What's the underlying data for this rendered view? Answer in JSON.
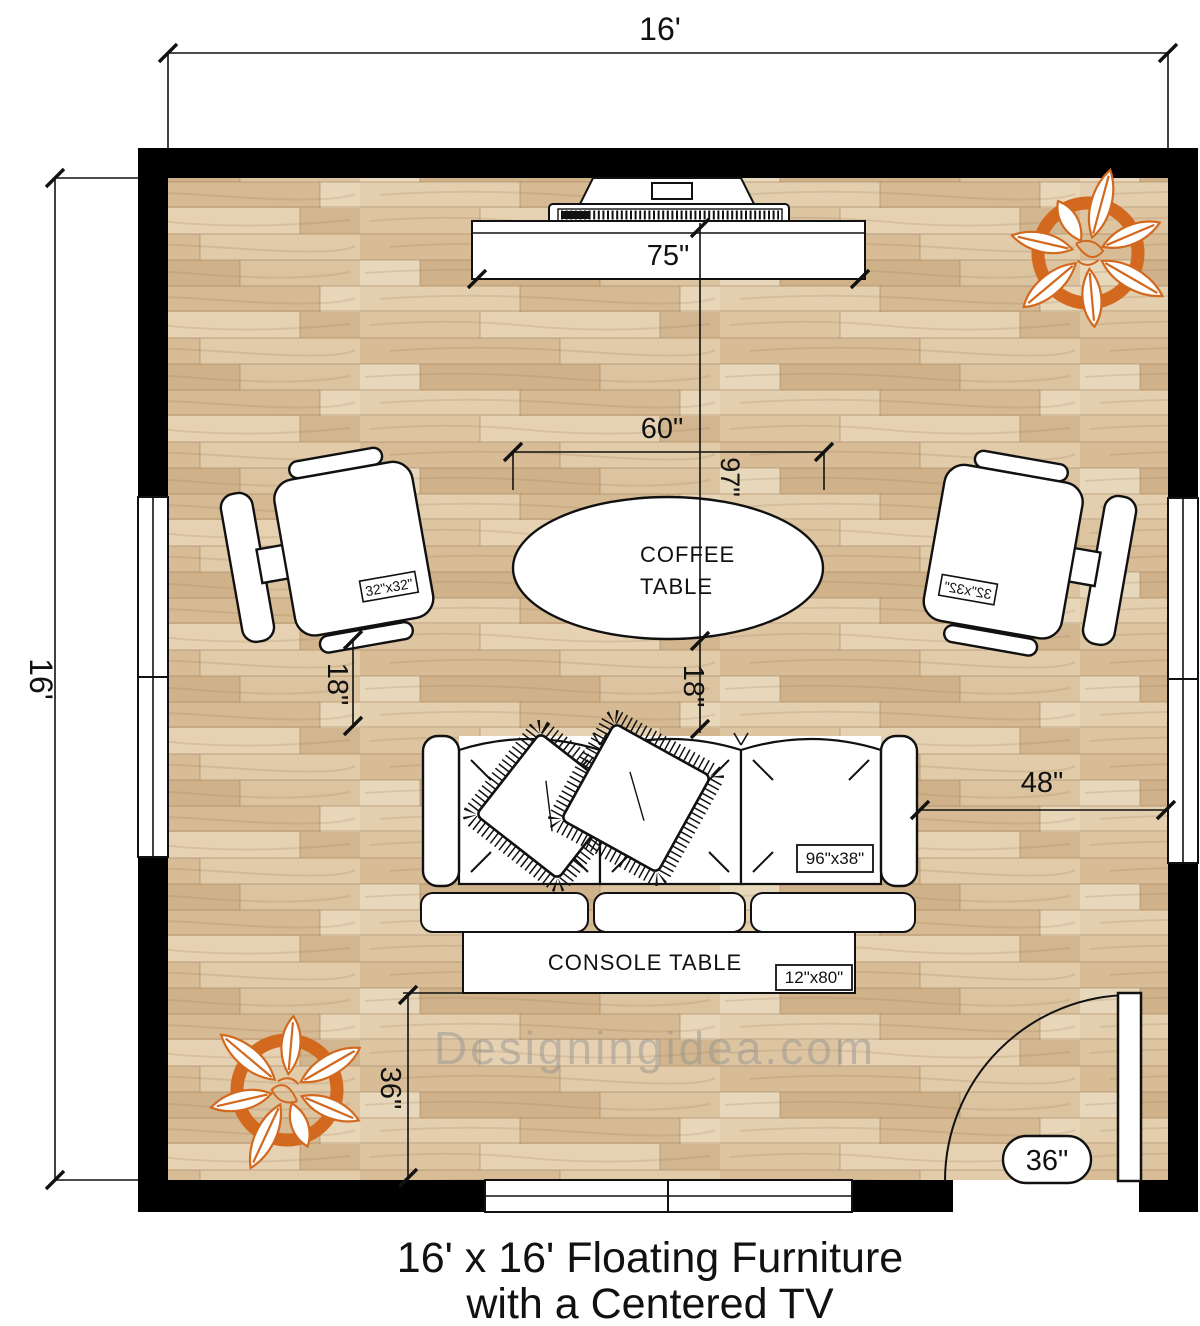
{
  "title": {
    "line1": "16' x 16' Floating Furniture",
    "line2": "with a Centered TV"
  },
  "watermark": "Designingidea.com",
  "dimensions": {
    "room_width": "16'",
    "room_height": "16'",
    "tv_width": "75\"",
    "coffee_table_width": "60\"",
    "tv_to_sofa": "97\"",
    "chair_to_sofa": "18\"",
    "coffee_to_sofa": "18\"",
    "sofa_to_wall": "48\"",
    "console_to_wall": "36\"",
    "door_width": "36\""
  },
  "furniture": {
    "coffee_table": {
      "line1": "COFFEE",
      "line2": "TABLE"
    },
    "console_table": {
      "label": "CONSOLE TABLE",
      "size": "12\"x80\""
    },
    "sofa": {
      "size": "96\"x38\""
    },
    "chair_left": {
      "size": "32\"x32\""
    },
    "chair_right": {
      "size": "32\"x32\""
    }
  },
  "colors": {
    "wall": "#000000",
    "plant_accent": "#d2691e",
    "floor_base": "#dcc3a0",
    "watermark": "#8f8f8f"
  }
}
